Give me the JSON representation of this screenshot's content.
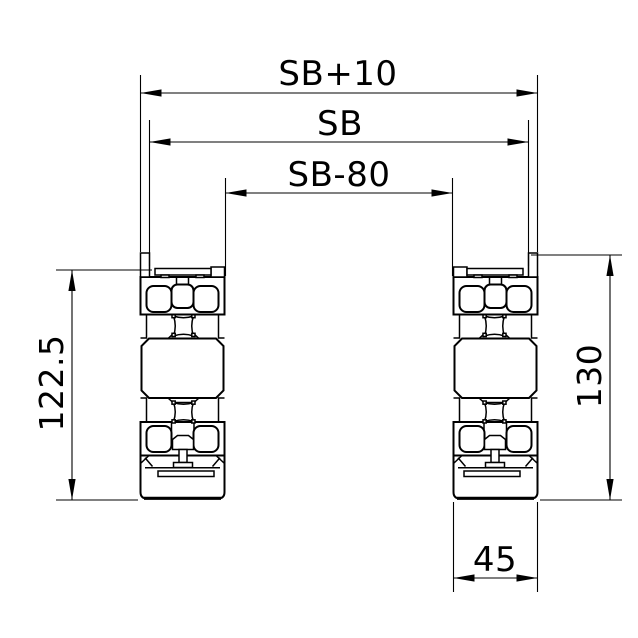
{
  "drawing": {
    "type": "technical-cross-section",
    "description": "Two mirrored aluminium extrusion profile cross-sections with dimension annotations",
    "background_color": "#ffffff",
    "line_color": "#000000",
    "dimensions": {
      "outer_width": {
        "label": "SB+10"
      },
      "nominal_width": {
        "label": "SB"
      },
      "inner_width": {
        "label": "SB-80"
      },
      "left_profile_height": {
        "label": "122.5"
      },
      "right_profile_height": {
        "label": "130"
      },
      "profile_width": {
        "label": "45"
      }
    }
  }
}
